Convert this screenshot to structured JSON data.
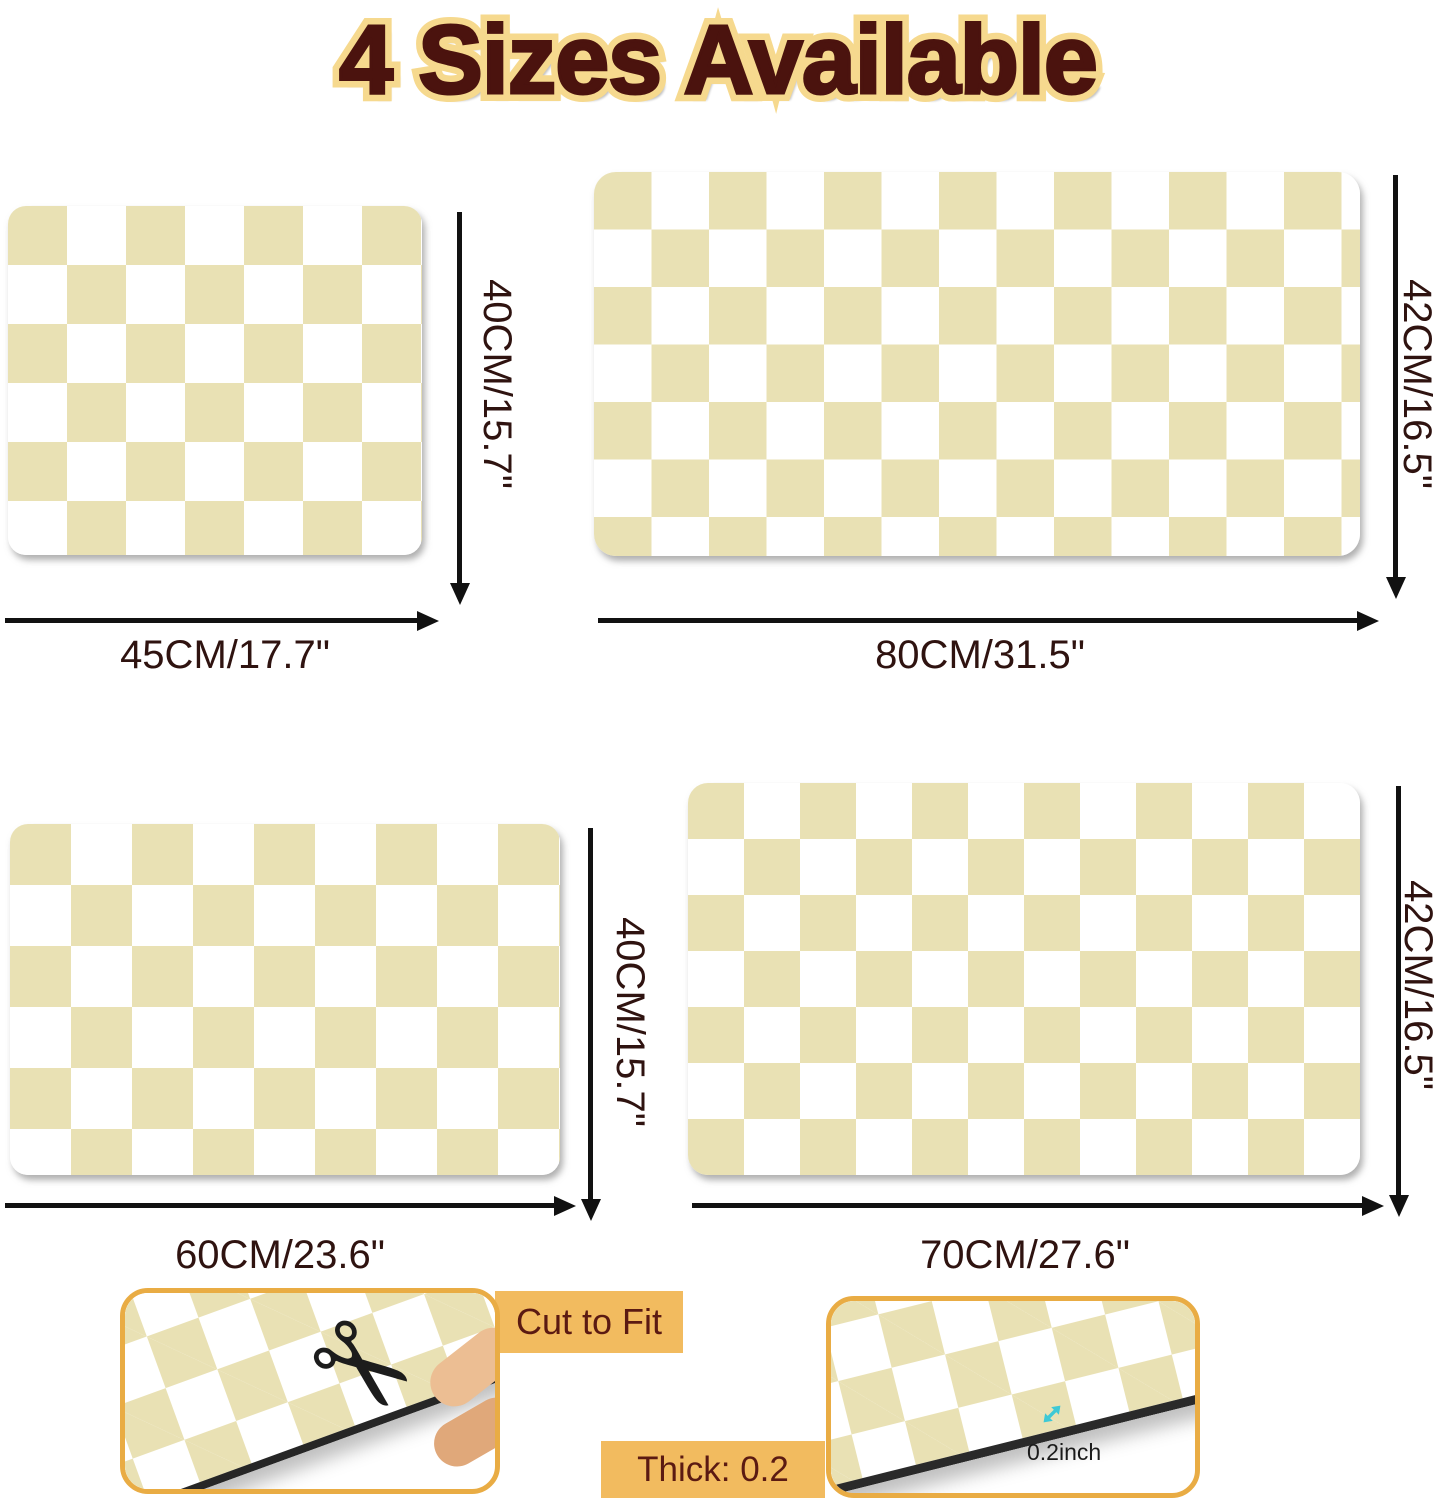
{
  "title": "4 Sizes Available",
  "mats": [
    {
      "name": "mat-45x40",
      "width_label": "45CM/17.7\"",
      "height_label": "40CM/15.7\""
    },
    {
      "name": "mat-80x42",
      "width_label": "80CM/31.5\"",
      "height_label": "42CM/16.5\""
    },
    {
      "name": "mat-60x40",
      "width_label": "60CM/23.6\"",
      "height_label": "40CM/15.7\""
    },
    {
      "name": "mat-70x42",
      "width_label": "70CM/27.6\"",
      "height_label": "42CM/16.5\""
    }
  ],
  "features": {
    "cut_to_fit": "Cut to Fit",
    "thickness": "Thick: 0.2 inch",
    "thickness_annotation": "0.2inch"
  },
  "icons": {
    "scissors": "✂"
  },
  "colors": {
    "checker_beige": "#e9e1b4",
    "title_fill": "#4b130e",
    "title_outline": "#f6d98e",
    "dimension_text": "#2f1310",
    "callout_bg": "#f2bb5f",
    "callout_text": "#5b1a12",
    "photo_frame": "#e9ac44",
    "thickness_marker": "#3ec9d6",
    "arrow": "#111111"
  }
}
